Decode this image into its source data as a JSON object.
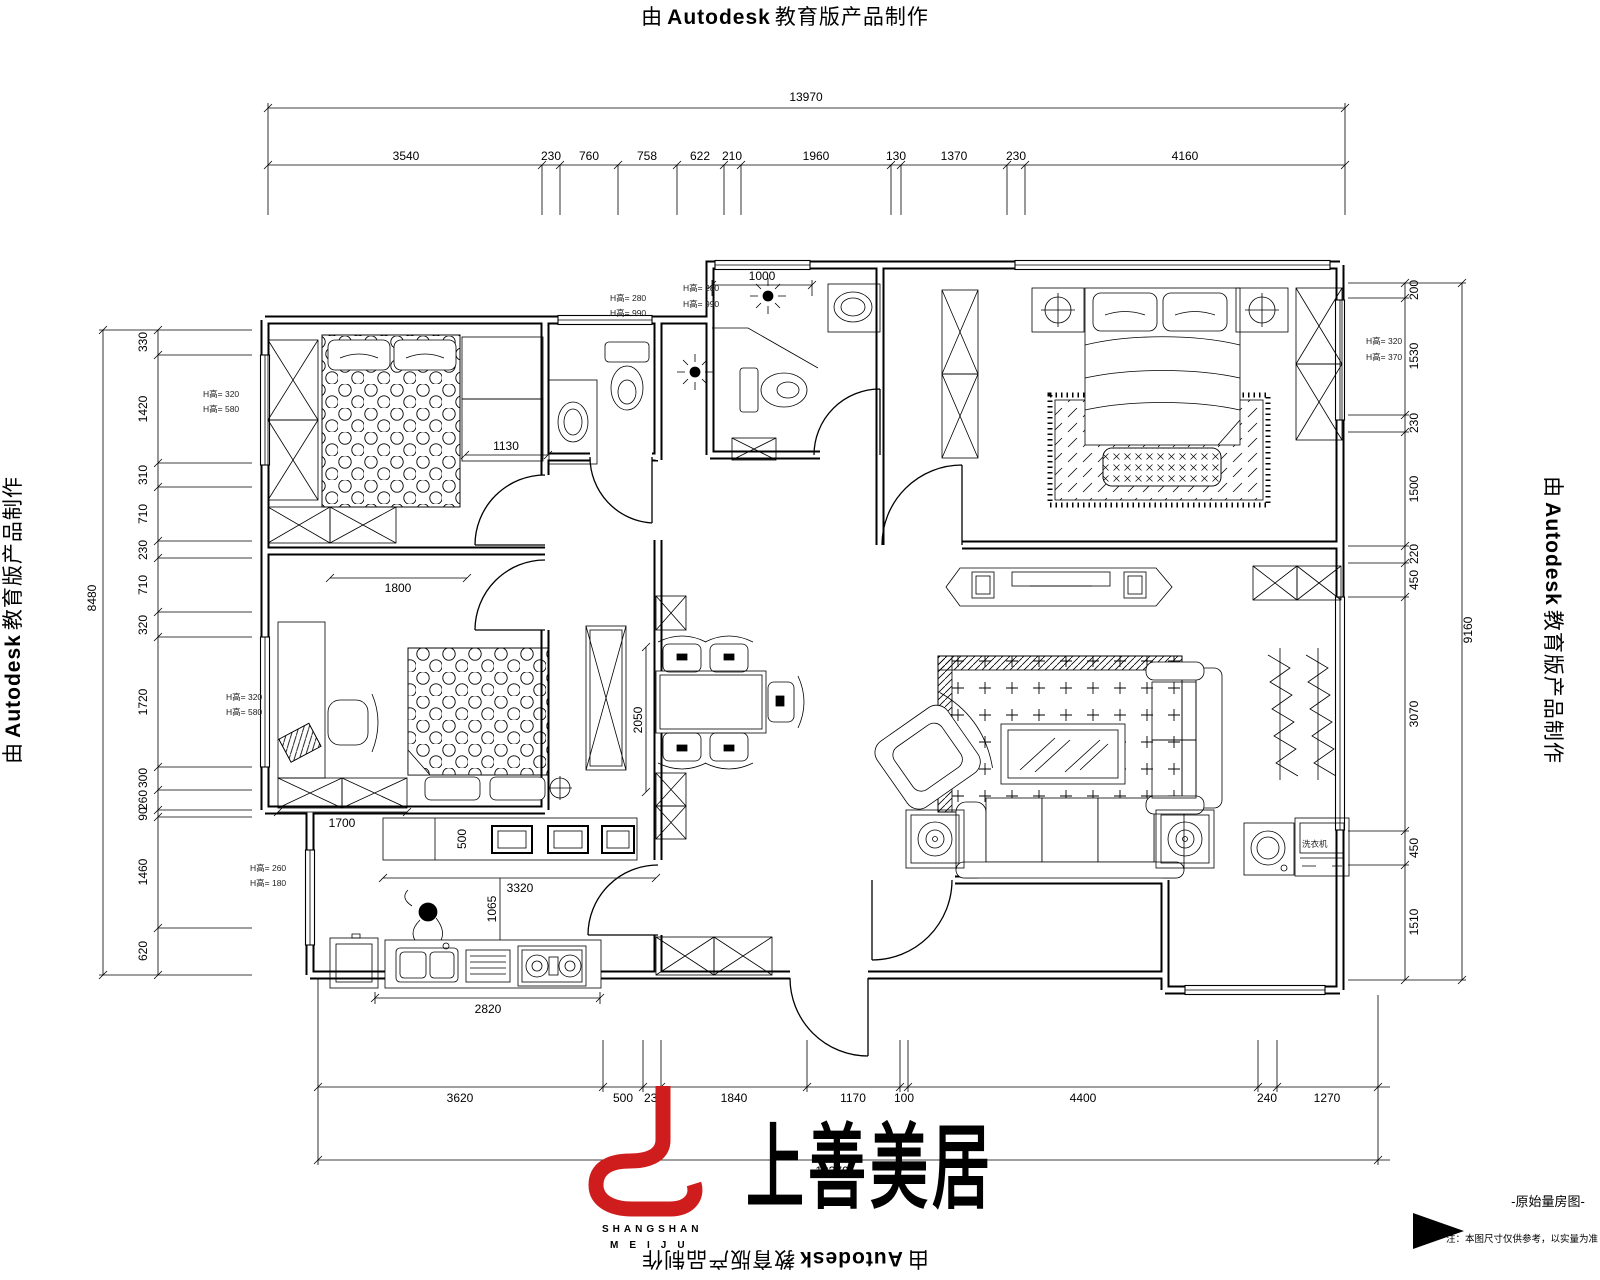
{
  "watermark": {
    "prefix": "由",
    "brand": "Autodesk",
    "suffix": "教育版产品制作"
  },
  "logo": {
    "cn": "上善美居",
    "en1": "SHANGSHAN",
    "en2": "MEIJU",
    "color": "#cf1d1d"
  },
  "footer": {
    "plan_title": "-原始量房图-",
    "note": "注：本图尺寸仅供参考，以实量为准"
  },
  "dims": {
    "top": {
      "total": "13970",
      "segments": [
        "3540",
        "230",
        "760",
        "758",
        "622",
        "210",
        "1960",
        "130",
        "1370",
        "230",
        "4160"
      ]
    },
    "bottom": {
      "total": "13370",
      "segments": [
        "3620",
        "500",
        "230",
        "1840",
        "1170",
        "100",
        "4400",
        "240",
        "1270"
      ]
    },
    "left": {
      "total": "8480",
      "segments": [
        "330",
        "1420",
        "310",
        "710",
        "230",
        "710",
        "320",
        "1720",
        "300",
        "260",
        "90",
        "1460",
        "620"
      ]
    },
    "right": {
      "total": "9160",
      "segments": [
        "200",
        "1530",
        "230",
        "1500",
        "220",
        "450",
        "3070",
        "450",
        "1510"
      ]
    }
  },
  "interior": {
    "bath2_width": "1000",
    "bed1_clear": "1130",
    "bed1_width": "1800",
    "desk_run": "1700",
    "cab_depth": "500",
    "kitchen_run": "3320",
    "kitchen_clear": "1065",
    "counter_run": "2820",
    "dining_depth": "2050"
  },
  "win_notes": {
    "a1": "H高= 280",
    "a2": "H高= 990",
    "b1": "H高= 280",
    "b2": "H高= 990",
    "l1a": "H高= 320",
    "l1b": "H高= 580",
    "l2a": "H高= 320",
    "l2b": "H高= 580",
    "ka": "H高= 260",
    "kb": "H高= 180",
    "ra": "H高= 320",
    "rb": "H高= 370"
  },
  "labels": {
    "washer": "洗衣机"
  }
}
